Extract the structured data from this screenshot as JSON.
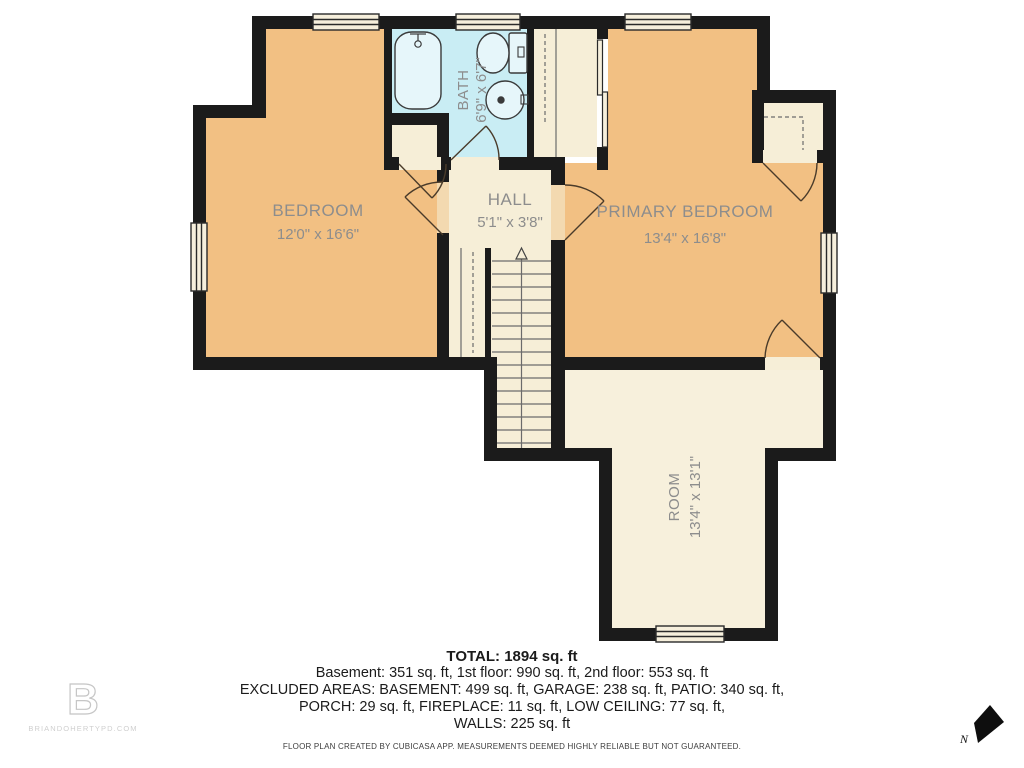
{
  "rooms": {
    "bedroom": {
      "name": "BEDROOM",
      "dims": "12'0\" x 16'6\""
    },
    "bath": {
      "name": "BATH",
      "dims": "6'9\" x 6'7\""
    },
    "hall": {
      "name": "HALL",
      "dims": "5'1\" x 3'8\""
    },
    "primary_bedroom": {
      "name": "PRIMARY BEDROOM",
      "dims": "13'4\" x 16'8\""
    },
    "room": {
      "name": "ROOM",
      "dims": "13'4\" x 13'1\""
    }
  },
  "summary": {
    "total": "TOTAL: 1894 sq. ft",
    "line1": "Basement: 351 sq. ft, 1st floor: 990 sq. ft, 2nd floor: 553 sq. ft",
    "line2": "EXCLUDED AREAS: BASEMENT: 499 sq. ft, GARAGE: 238 sq. ft, PATIO: 340 sq. ft,",
    "line3": "PORCH: 29 sq. ft, FIREPLACE: 11 sq. ft, LOW CEILING: 77 sq. ft,",
    "line4": "WALLS: 225 sq. ft"
  },
  "footer": {
    "disclaimer": "FLOOR PLAN CREATED BY CUBICASA APP. MEASUREMENTS DEEMED HIGHLY RELIABLE BUT NOT GUARANTEED."
  },
  "branding": {
    "logo_letter": "B",
    "website": "BRIANDOHERTYPD.COM"
  },
  "compass": {
    "label": "N"
  },
  "colors": {
    "wall": "#1b1b1b",
    "floor_orange": "#f2c083",
    "floor_cream": "#f6eed7",
    "floor_room": "#f7f0dc",
    "floor_blue": "#c9edf4",
    "label_gray": "#8d8d8d"
  }
}
